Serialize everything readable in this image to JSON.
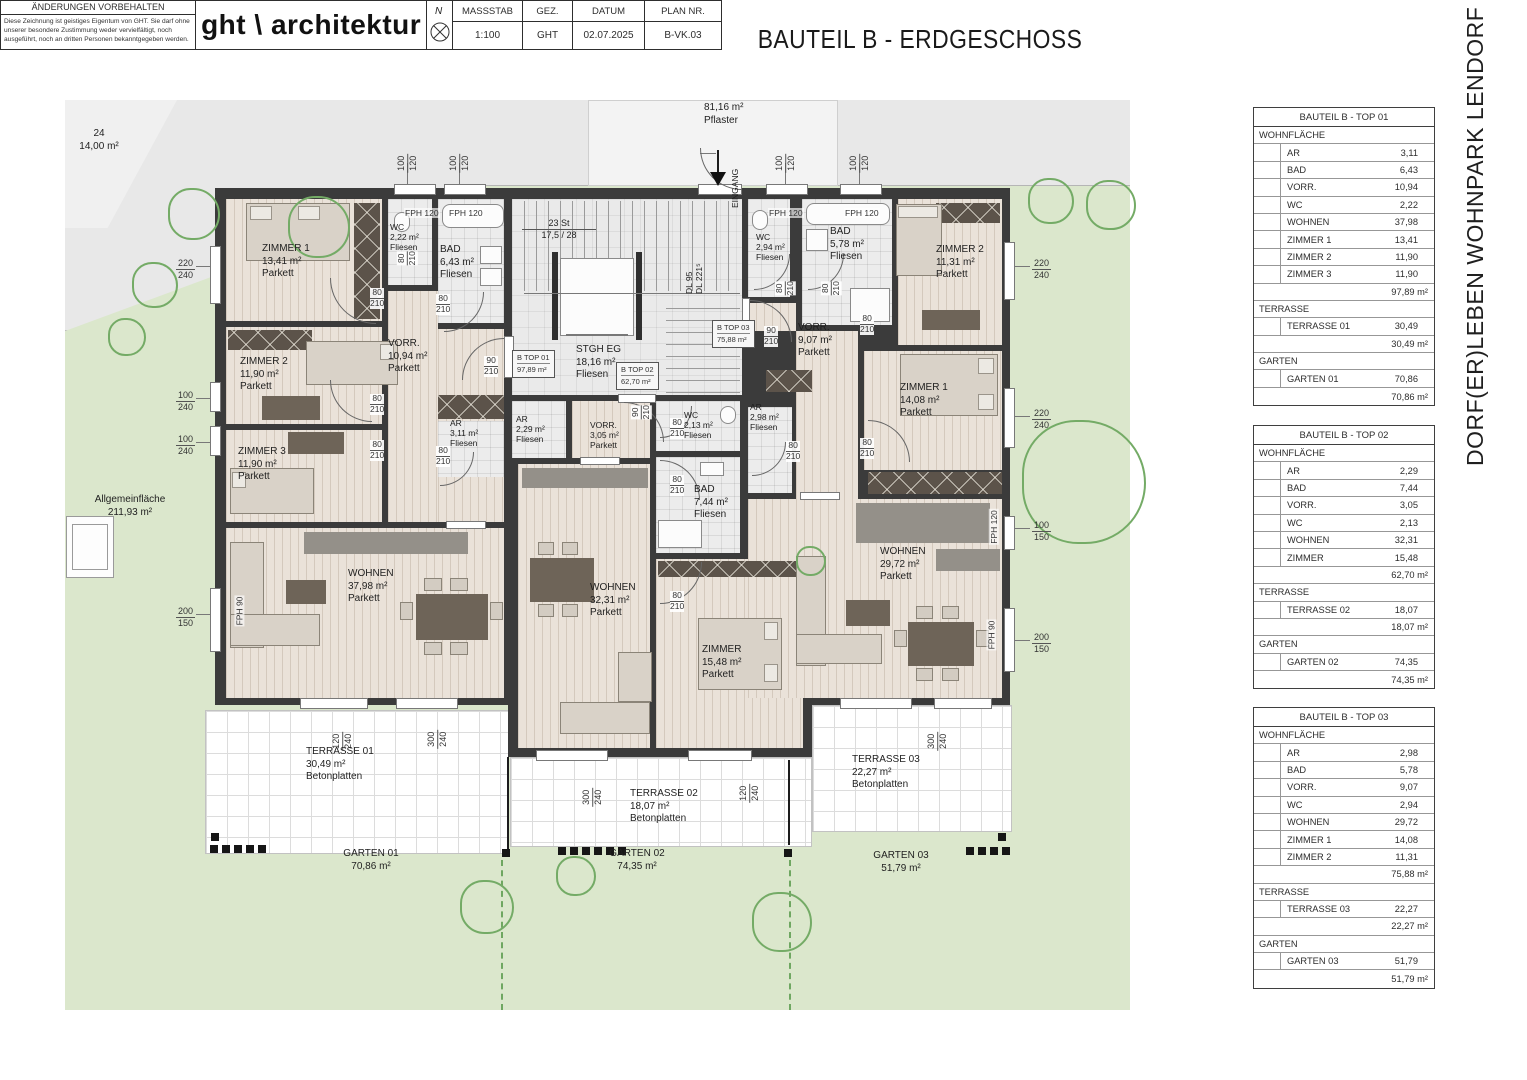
{
  "title": "BAUTEIL B - ERDGESCHOSS",
  "project_vertical": "DORF(ER)LEBEN WOHNPARK LENDORF 4.0",
  "site": {
    "pflaster_area": "81,16 m²",
    "pflaster_label": "Pflaster",
    "parcel_no": "24",
    "parcel_area": "14,00 m²",
    "allgemein_label": "Allgemeinfläche",
    "allgemein_area": "211,93 m²",
    "eingang": "EINGANG",
    "stair_count": "23 St",
    "stair_ratio": "17,5 / 28",
    "dl1": "DL 95",
    "dl2": "DL 221⁵"
  },
  "rooms": {
    "t01_zimmer1": {
      "name": "ZIMMER 1",
      "area": "13,41 m²",
      "floor": "Parkett"
    },
    "t01_zimmer2": {
      "name": "ZIMMER 2",
      "area": "11,90 m²",
      "floor": "Parkett"
    },
    "t01_zimmer3": {
      "name": "ZIMMER 3",
      "area": "11,90 m²",
      "floor": "Parkett"
    },
    "t01_wc": {
      "name": "WC",
      "area": "2,22 m²",
      "floor": "Fliesen"
    },
    "t01_bad": {
      "name": "BAD",
      "area": "6,43 m²",
      "floor": "Fliesen"
    },
    "t01_vorr": {
      "name": "VORR.",
      "area": "10,94 m²",
      "floor": "Parkett"
    },
    "t01_ar": {
      "name": "AR",
      "area": "3,11 m²",
      "floor": "Fliesen"
    },
    "t01_wohnen": {
      "name": "WOHNEN",
      "area": "37,98 m²",
      "floor": "Parkett"
    },
    "stgh": {
      "name": "STGH EG",
      "area": "18,16 m²",
      "floor": "Fliesen"
    },
    "t02_ar": {
      "name": "AR",
      "area": "2,29 m²",
      "floor": "Fliesen"
    },
    "t02_vorr": {
      "name": "VORR.",
      "area": "3,05 m²",
      "floor": "Parkett"
    },
    "t02_wc": {
      "name": "WC",
      "area": "2,13 m²",
      "floor": "Fliesen"
    },
    "t02_bad": {
      "name": "BAD",
      "area": "7,44 m²",
      "floor": "Fliesen"
    },
    "t02_wohnen": {
      "name": "WOHNEN",
      "area": "32,31 m²",
      "floor": "Parkett"
    },
    "t02_zimmer": {
      "name": "ZIMMER",
      "area": "15,48 m²",
      "floor": "Parkett"
    },
    "t03_wc": {
      "name": "WC",
      "area": "2,94 m²",
      "floor": "Fliesen"
    },
    "t03_bad": {
      "name": "BAD",
      "area": "5,78 m²",
      "floor": "Fliesen"
    },
    "t03_zimmer2": {
      "name": "ZIMMER 2",
      "area": "11,31 m²",
      "floor": "Parkett"
    },
    "t03_vorr": {
      "name": "VORR.",
      "area": "9,07 m²",
      "floor": "Parkett"
    },
    "t03_ar": {
      "name": "AR",
      "area": "2,98 m²",
      "floor": "Fliesen"
    },
    "t03_zimmer1": {
      "name": "ZIMMER 1",
      "area": "14,08 m²",
      "floor": "Parkett"
    },
    "t03_wohnen": {
      "name": "WOHNEN",
      "area": "29,72 m²",
      "floor": "Parkett"
    }
  },
  "unit_tags": {
    "top01": {
      "name": "B TOP 01",
      "area": "97,89 m²"
    },
    "top02": {
      "name": "B TOP 02",
      "area": "62,70 m²"
    },
    "top03": {
      "name": "B TOP 03",
      "area": "75,88 m²"
    }
  },
  "outdoor": {
    "terrasse01": {
      "name": "TERRASSE 01",
      "area": "30,49 m²",
      "floor": "Betonplatten"
    },
    "terrasse02": {
      "name": "TERRASSE 02",
      "area": "18,07 m²",
      "floor": "Betonplatten"
    },
    "terrasse03": {
      "name": "TERRASSE 03",
      "area": "22,27 m²",
      "floor": "Betonplatten"
    },
    "garten01": {
      "name": "GARTEN 01",
      "area": "70,86 m²"
    },
    "garten02": {
      "name": "GARTEN 02",
      "area": "74,35 m²"
    },
    "garten03": {
      "name": "GARTEN 03",
      "area": "51,79 m²"
    }
  },
  "dim_labels": [
    "100/120",
    "100/120",
    "100/120",
    "100/120",
    "220/240",
    "100/240",
    "100/240",
    "200/150",
    "220/240",
    "220/240",
    "100/150",
    "200/150",
    "120/240",
    "300/240",
    "300/240",
    "120/240",
    "300/240"
  ],
  "door_labels": [
    "80/210",
    "80/210",
    "80/210",
    "80/210",
    "80/210",
    "90/210",
    "80/210",
    "80/210",
    "80/210",
    "90/210",
    "80/210",
    "80/210",
    "80/210",
    "80/210",
    "90/210",
    "80/210",
    "80/210"
  ],
  "fph_labels": [
    "FPH 120",
    "FPH 120",
    "FPH 120",
    "FPH 120",
    "FPH 120",
    "FPH 90",
    "FPH 90"
  ],
  "tables": [
    {
      "title": "BAUTEIL B - TOP 01",
      "rows": [
        {
          "type": "section",
          "label": "WOHNFLÄCHE"
        },
        {
          "type": "item",
          "label": "AR",
          "value": "3,11"
        },
        {
          "type": "item",
          "label": "BAD",
          "value": "6,43"
        },
        {
          "type": "item",
          "label": "VORR.",
          "value": "10,94"
        },
        {
          "type": "item",
          "label": "WC",
          "value": "2,22"
        },
        {
          "type": "item",
          "label": "WOHNEN",
          "value": "37,98"
        },
        {
          "type": "item",
          "label": "ZIMMER 1",
          "value": "13,41"
        },
        {
          "type": "item",
          "label": "ZIMMER 2",
          "value": "11,90"
        },
        {
          "type": "item",
          "label": "ZIMMER 3",
          "value": "11,90"
        },
        {
          "type": "total",
          "value": "97,89 m²"
        },
        {
          "type": "section",
          "label": "TERRASSE"
        },
        {
          "type": "item",
          "label": "TERRASSE 01",
          "value": "30,49"
        },
        {
          "type": "total",
          "value": "30,49 m²"
        },
        {
          "type": "section",
          "label": "GARTEN"
        },
        {
          "type": "item",
          "label": "GARTEN 01",
          "value": "70,86"
        },
        {
          "type": "total",
          "value": "70,86 m²"
        }
      ]
    },
    {
      "title": "BAUTEIL B - TOP 02",
      "rows": [
        {
          "type": "section",
          "label": "WOHNFLÄCHE"
        },
        {
          "type": "item",
          "label": "AR",
          "value": "2,29"
        },
        {
          "type": "item",
          "label": "BAD",
          "value": "7,44"
        },
        {
          "type": "item",
          "label": "VORR.",
          "value": "3,05"
        },
        {
          "type": "item",
          "label": "WC",
          "value": "2,13"
        },
        {
          "type": "item",
          "label": "WOHNEN",
          "value": "32,31"
        },
        {
          "type": "item",
          "label": "ZIMMER",
          "value": "15,48"
        },
        {
          "type": "total",
          "value": "62,70 m²"
        },
        {
          "type": "section",
          "label": "TERRASSE"
        },
        {
          "type": "item",
          "label": "TERRASSE 02",
          "value": "18,07"
        },
        {
          "type": "total",
          "value": "18,07 m²"
        },
        {
          "type": "section",
          "label": "GARTEN"
        },
        {
          "type": "item",
          "label": "GARTEN 02",
          "value": "74,35"
        },
        {
          "type": "total",
          "value": "74,35 m²"
        }
      ]
    },
    {
      "title": "BAUTEIL B - TOP 03",
      "rows": [
        {
          "type": "section",
          "label": "WOHNFLÄCHE"
        },
        {
          "type": "item",
          "label": "AR",
          "value": "2,98"
        },
        {
          "type": "item",
          "label": "BAD",
          "value": "5,78"
        },
        {
          "type": "item",
          "label": "VORR.",
          "value": "9,07"
        },
        {
          "type": "item",
          "label": "WC",
          "value": "2,94"
        },
        {
          "type": "item",
          "label": "WOHNEN",
          "value": "29,72"
        },
        {
          "type": "item",
          "label": "ZIMMER 1",
          "value": "14,08"
        },
        {
          "type": "item",
          "label": "ZIMMER 2",
          "value": "11,31"
        },
        {
          "type": "total",
          "value": "75,88 m²"
        },
        {
          "type": "section",
          "label": "TERRASSE"
        },
        {
          "type": "item",
          "label": "TERRASSE 03",
          "value": "22,27"
        },
        {
          "type": "total",
          "value": "22,27 m²"
        },
        {
          "type": "section",
          "label": "GARTEN"
        },
        {
          "type": "item",
          "label": "GARTEN 03",
          "value": "51,79"
        },
        {
          "type": "total",
          "value": "51,79 m²"
        }
      ]
    }
  ],
  "titleblock": {
    "aenderungen": "ÄNDERUNGEN VORBEHALTEN",
    "disclaimer": "Diese Zeichnung ist geistiges Eigentum von GHT. Sie darf ohne unserer besondere Zustimmung weder vervielfältigt, noch ausgeführt, noch an dritten Personen bekanntgegeben werden.",
    "logo": "ght \\ architektur",
    "north_label": "N",
    "fields": [
      {
        "label": "MASSSTAB",
        "value": "1:100"
      },
      {
        "label": "GEZ.",
        "value": "GHT"
      },
      {
        "label": "DATUM",
        "value": "02.07.2025"
      },
      {
        "label": "PLAN NR.",
        "value": "B-VK.03"
      }
    ]
  }
}
